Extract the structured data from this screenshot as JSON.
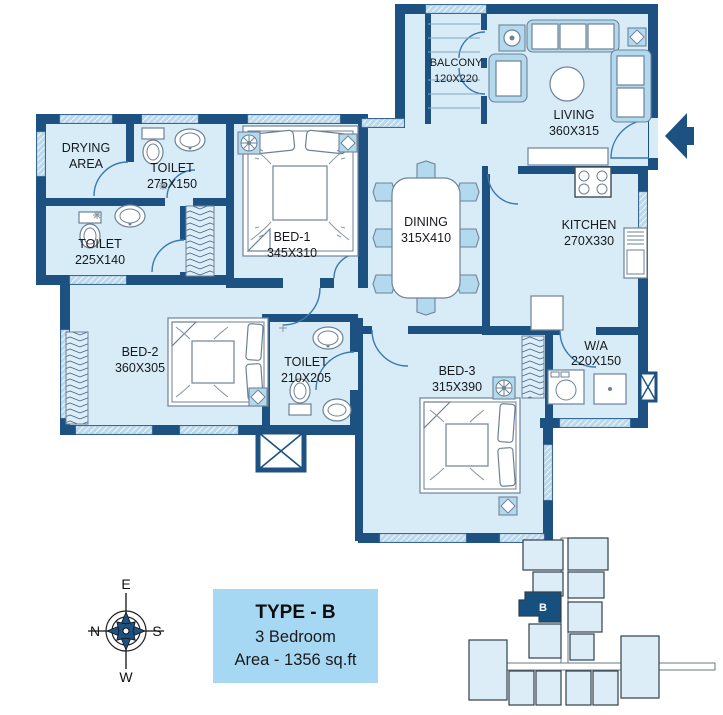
{
  "colors": {
    "wall": "#1d5181",
    "floor": "#d8ecf8",
    "accent": "#b3d9ee",
    "line": "#6e8296",
    "door": "#3b79b0",
    "text": "#15181c",
    "infobox_bg": "#a7d8f3",
    "keyplan_fill": "#ddedf8",
    "keyplan_stroke": "#31404c",
    "highlight": "#16507f",
    "window_fill": "#bdd8ea"
  },
  "icons": {
    "entry_arrow": "left-arrow",
    "compass_rose": "8-point-star",
    "ceiling_fan": "circle-with-spokes",
    "shaft": "crossed-box"
  },
  "floor_plan": {
    "rooms": {
      "drying_area": {
        "line1": "DRYING",
        "line2": "AREA"
      },
      "toilet_top": {
        "line1": "TOILET",
        "line2": "275X150"
      },
      "toilet_left": {
        "line1": "TOILET",
        "line2": "225X140"
      },
      "bed1": {
        "line1": "BED-1",
        "line2": "345X310"
      },
      "balcony": {
        "line1": "BALCONY",
        "line2": "120X220"
      },
      "living": {
        "line1": "LIVING",
        "line2": "360X315"
      },
      "dining": {
        "line1": "DINING",
        "line2": "315X410"
      },
      "kitchen": {
        "line1": "KITCHEN",
        "line2": "270X330"
      },
      "wash_area": {
        "line1": "W/A",
        "line2": "220X150"
      },
      "bed2": {
        "line1": "BED-2",
        "line2": "360X305"
      },
      "toilet_mid": {
        "line1": "TOILET",
        "line2": "210X205"
      },
      "bed3": {
        "line1": "BED-3",
        "line2": "315X390"
      }
    }
  },
  "compass": {
    "top": "E",
    "left": "N",
    "right": "S",
    "bottom": "W"
  },
  "info_box": {
    "type": "TYPE - B",
    "bedrooms": "3 Bedroom",
    "area": "Area - 1356 sq.ft"
  },
  "key_plan": {
    "highlighted_unit": "B"
  }
}
